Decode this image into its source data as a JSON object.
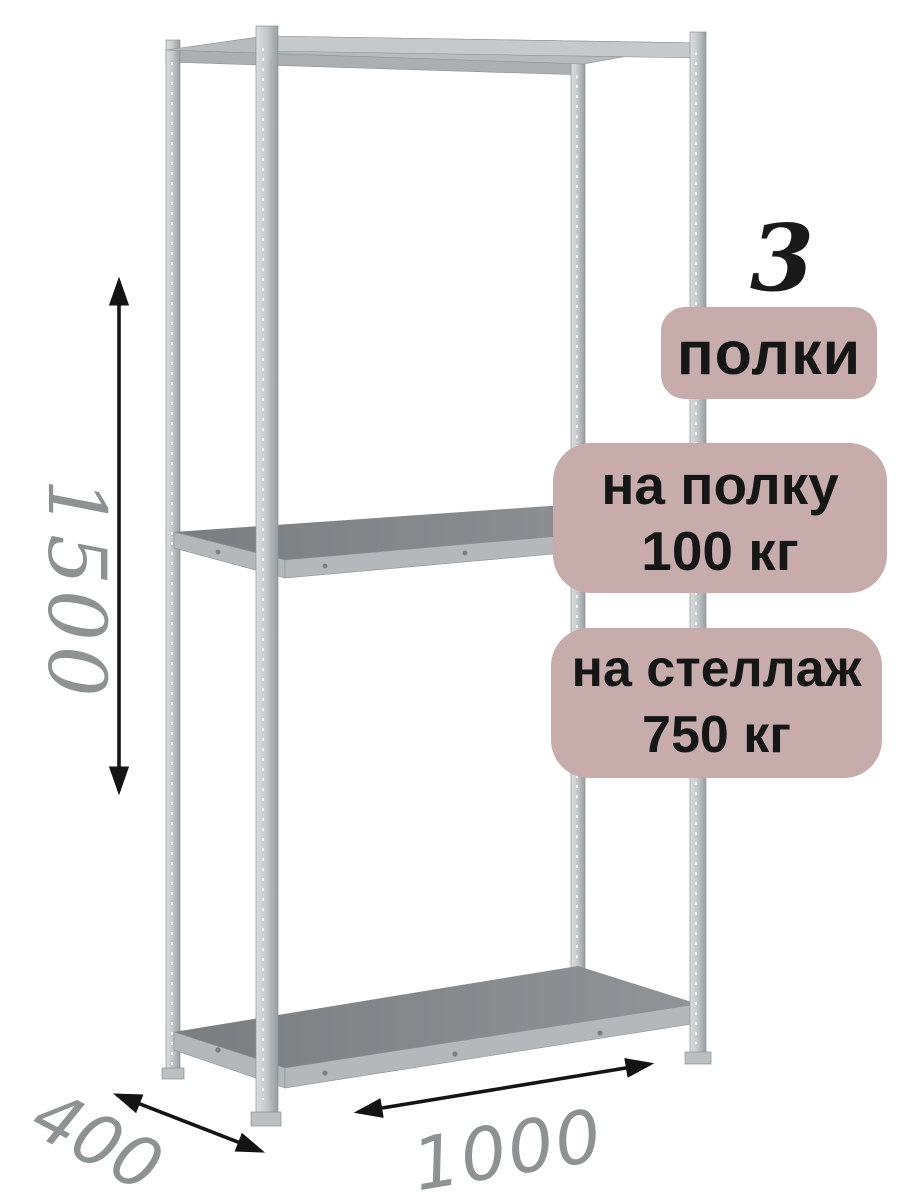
{
  "illustration": {
    "description": "3D render of a gray metal boltless shelving rack with three shelves",
    "colors": {
      "post": "#c6cacc",
      "post_edge": "#979da0",
      "shelf_top": "#84888b",
      "shelf_edge": "#b4b8bb",
      "background": "#ffffff"
    }
  },
  "callouts": {
    "badge_background": "#c8acac",
    "badge_text_color": "#161616",
    "shelf_count": {
      "number": "3",
      "label": "полки"
    },
    "shelf_load": {
      "line1": "на полку",
      "line2": "100 кг"
    },
    "rack_load": {
      "line1": "на стеллаж",
      "line2": "750 кг"
    }
  },
  "dimensions": {
    "height": "1500",
    "depth": "400",
    "width": "1000",
    "label_color": "#8f9293",
    "arrow_color": "#141414"
  }
}
